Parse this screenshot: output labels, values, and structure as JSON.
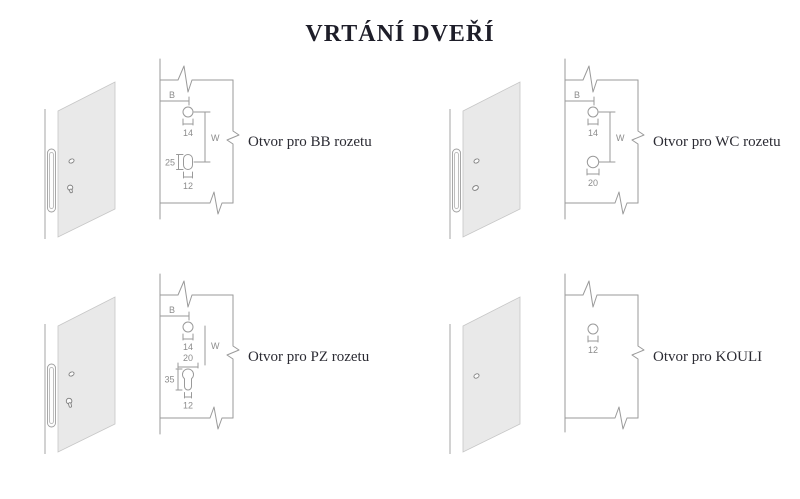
{
  "title": "VRTÁNÍ DVEŘÍ",
  "colors": {
    "line": "#9a9a9a",
    "panel_fill": "#e9e9e9",
    "panel_stroke": "#c6c6c6",
    "dim_text": "#8c8c8c",
    "label_text": "#2b2b33",
    "title_text": "#1e1e29"
  },
  "diagrams": {
    "bb": {
      "label": "Otvor pro BB rozetu",
      "dim_b": "B",
      "dim_w": "W",
      "top_hole_dia": "14",
      "slot_height": "25",
      "slot_width": "12"
    },
    "wc": {
      "label": "Otvor pro WC rozetu",
      "dim_b": "B",
      "dim_w": "W",
      "top_hole_dia": "14",
      "bottom_hole_dia": "20"
    },
    "pz": {
      "label": "Otvor pro PZ rozetu",
      "dim_b": "B",
      "dim_w": "W",
      "top_hole_dia": "14",
      "cylinder_dia": "20",
      "cylinder_height": "35",
      "cylinder_width": "12"
    },
    "kouli": {
      "label": "Otvor pro KOULI",
      "hole_dia": "12"
    }
  }
}
